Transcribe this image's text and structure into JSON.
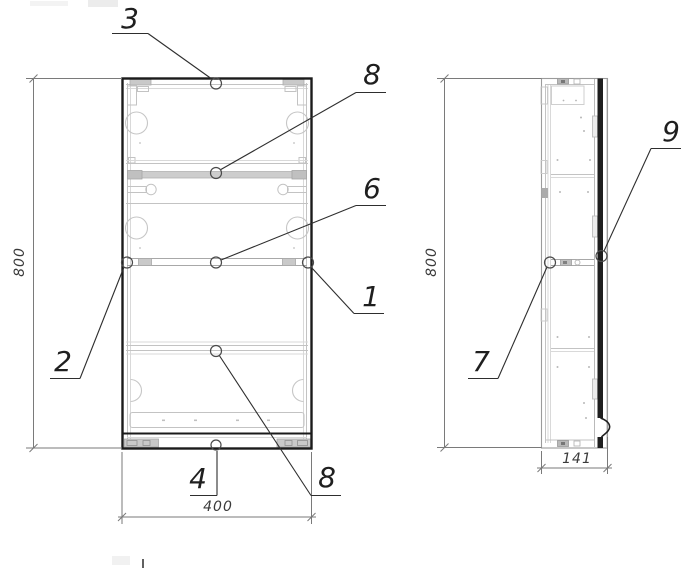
{
  "callouts": {
    "n1": {
      "label": "1"
    },
    "n2": {
      "label": "2"
    },
    "n3": {
      "label": "3"
    },
    "n4": {
      "label": "4"
    },
    "n6": {
      "label": "6"
    },
    "n7": {
      "label": "7"
    },
    "n8_top": {
      "label": "8"
    },
    "n8_bottom": {
      "label": "8"
    },
    "n9": {
      "label": "9"
    }
  },
  "dimensions": {
    "front_height": "800",
    "front_width": "400",
    "side_height": "800",
    "side_depth": "141"
  },
  "colors": {
    "outline": "#1b1b1b",
    "detail_gray": "#c3c3c3",
    "dimension_gray": "#7a7a7a",
    "background": "#ffffff"
  }
}
